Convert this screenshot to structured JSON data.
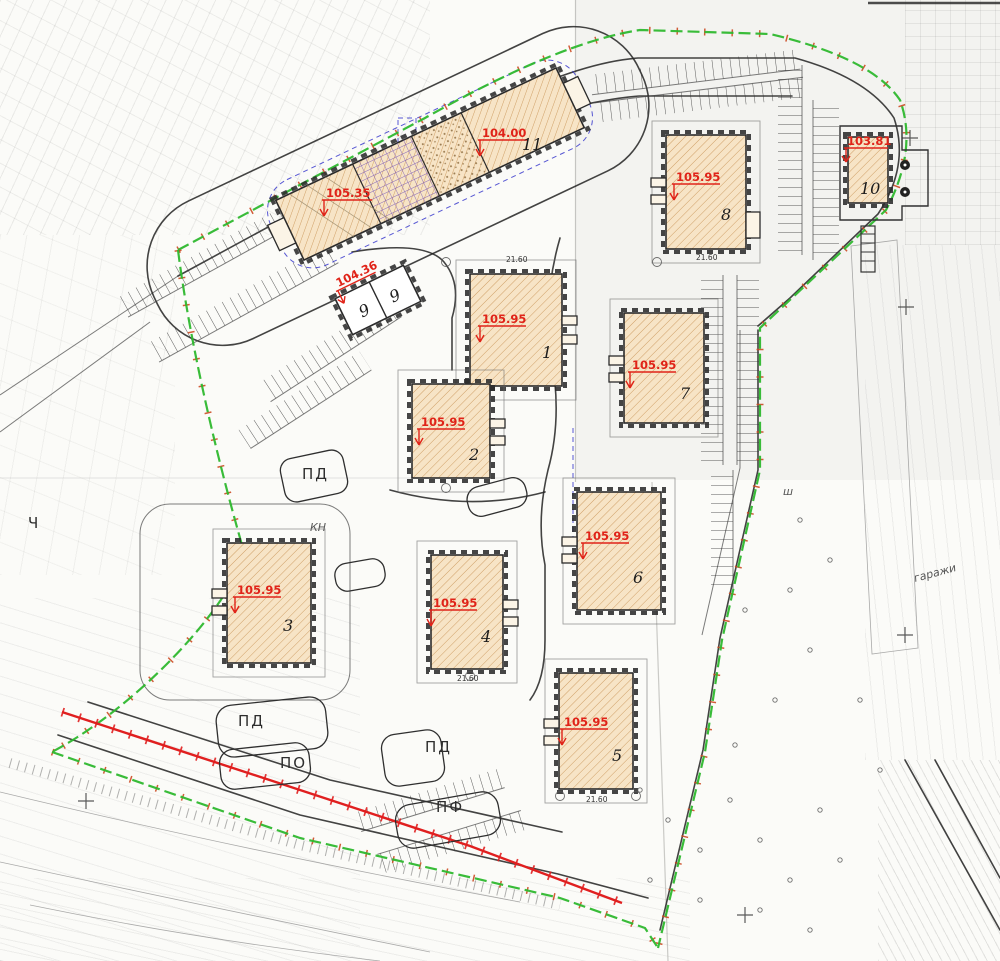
{
  "colors": {
    "boundary_green": "#2eb82e",
    "red_line": "#e01f1f",
    "elevation_red": "#e02318",
    "building_fill": "#f7e4c6",
    "building_hatch": "#cf9f66",
    "outline_dark": "#2b2b2b",
    "utility_blue": "#3a3acc",
    "paper": "#fbfbf8"
  },
  "buildings": [
    {
      "number": "1",
      "elevation": "105.95"
    },
    {
      "number": "2",
      "elevation": "105.95"
    },
    {
      "number": "3",
      "elevation": "105.95"
    },
    {
      "number": "4",
      "elevation": "105.95"
    },
    {
      "number": "5",
      "elevation": "105.95"
    },
    {
      "number": "6",
      "elevation": "105.95"
    },
    {
      "number": "7",
      "elevation": "105.95"
    },
    {
      "number": "8",
      "elevation": "105.95"
    },
    {
      "number": "9",
      "elevation": "104.36",
      "cell_left": "9",
      "cell_right": "9"
    },
    {
      "number": "10",
      "elevation": "103.81"
    },
    {
      "number": "11",
      "elevation_left": "105.35",
      "elevation_right": "104.00"
    }
  ],
  "area_labels": {
    "pd_center": "ПД",
    "pd_bottom_left": "ПД",
    "pd_bottom_center": "ПД",
    "po": "ПО",
    "pf": "ПФ",
    "kn": "КН",
    "ch": "Ч",
    "sh": "ш",
    "garages": "гаражи"
  },
  "dimensions": {
    "building_width": "21.60"
  }
}
